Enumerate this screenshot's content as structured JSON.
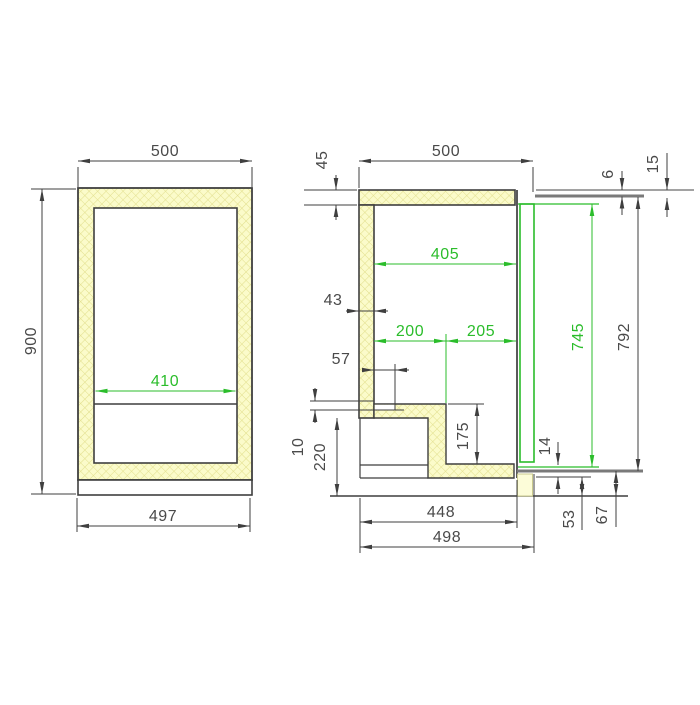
{
  "front_view": {
    "top_width": "500",
    "height": "900",
    "interior_width": "410",
    "base_width": "497"
  },
  "side_view": {
    "top_panel_thickness": "45",
    "top_depth": "500",
    "lid_gap": "6",
    "front_overhang": "15",
    "interior_depth": "405",
    "wall_thickness": "43",
    "depth_front": "200",
    "depth_back": "205",
    "recess_inset": "57",
    "floor_offset": "10",
    "machine_recess_height": "220",
    "step_height": "175",
    "door_liner_height": "745",
    "door_height": "792",
    "door_bottom_gap": "14",
    "bottom_detail_a": "53",
    "bottom_detail_b": "67",
    "depth_to_door_inner": "448",
    "overall_depth": "498"
  },
  "colors": {
    "dimension_line": "#3f3f3f",
    "dimension_text": "#4a4a4a",
    "highlight_green": "#2bbd2b",
    "hatch_fill": "#fbfbca",
    "hatch_line": "#e2df8e",
    "panel_gray": "#7a7a7a",
    "background": "#ffffff"
  }
}
